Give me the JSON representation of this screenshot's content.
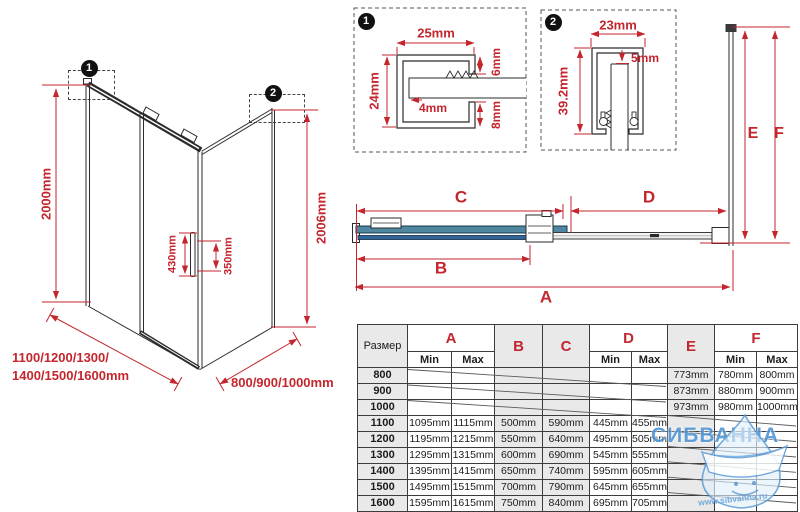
{
  "colors": {
    "dimension_red": "#c4262e",
    "glass_teal": "#4f86a0",
    "glass_blue": "#2f6597",
    "watermark_blue": "#5b9bd5"
  },
  "left_diagram": {
    "badge1": "1",
    "badge2": "2",
    "height_left": "2000mm",
    "height_right": "2006mm",
    "handle_height": "430mm",
    "handle_holes": "350mm",
    "width_options_line1": "1100/1200/1300/",
    "width_options_line2": "1400/1500/1600mm",
    "depth_options": "800/900/1000mm"
  },
  "detail1": {
    "badge": "1",
    "width": "25mm",
    "height": "24mm",
    "top_gap": "6mm",
    "pocket": "4mm",
    "bottom_gap": "8mm"
  },
  "detail2": {
    "badge": "2",
    "width": "23mm",
    "height": "39.2mm",
    "gap": "5mm"
  },
  "dims": {
    "a": "A",
    "b": "B",
    "c": "C",
    "d": "D",
    "e": "E",
    "f": "F"
  },
  "table": {
    "size_header": "Размер",
    "min": "Min",
    "max": "Max",
    "col_a": "A",
    "col_b": "B",
    "col_c": "C",
    "col_d": "D",
    "col_e": "E",
    "col_f": "F",
    "rows": [
      {
        "size": "800",
        "a_min": "",
        "a_max": "",
        "b": "",
        "c": "",
        "d_min": "",
        "d_max": "",
        "e": "773mm",
        "f_min": "780mm",
        "f_max": "800mm"
      },
      {
        "size": "900",
        "a_min": "",
        "a_max": "",
        "b": "",
        "c": "",
        "d_min": "",
        "d_max": "",
        "e": "873mm",
        "f_min": "880mm",
        "f_max": "900mm"
      },
      {
        "size": "1000",
        "a_min": "",
        "a_max": "",
        "b": "",
        "c": "",
        "d_min": "",
        "d_max": "",
        "e": "973mm",
        "f_min": "980mm",
        "f_max": "1000mm"
      },
      {
        "size": "1100",
        "a_min": "1095mm",
        "a_max": "1115mm",
        "b": "500mm",
        "c": "590mm",
        "d_min": "445mm",
        "d_max": "455mm",
        "e": "",
        "f_min": "",
        "f_max": ""
      },
      {
        "size": "1200",
        "a_min": "1195mm",
        "a_max": "1215mm",
        "b": "550mm",
        "c": "640mm",
        "d_min": "495mm",
        "d_max": "505mm",
        "e": "",
        "f_min": "",
        "f_max": ""
      },
      {
        "size": "1300",
        "a_min": "1295mm",
        "a_max": "1315mm",
        "b": "600mm",
        "c": "690mm",
        "d_min": "545mm",
        "d_max": "555mm",
        "e": "",
        "f_min": "",
        "f_max": ""
      },
      {
        "size": "1400",
        "a_min": "1395mm",
        "a_max": "1415mm",
        "b": "650mm",
        "c": "740mm",
        "d_min": "595mm",
        "d_max": "605mm",
        "e": "",
        "f_min": "",
        "f_max": ""
      },
      {
        "size": "1500",
        "a_min": "1495mm",
        "a_max": "1515mm",
        "b": "700mm",
        "c": "790mm",
        "d_min": "645mm",
        "d_max": "655mm",
        "e": "",
        "f_min": "",
        "f_max": ""
      },
      {
        "size": "1600",
        "a_min": "1595mm",
        "a_max": "1615mm",
        "b": "750mm",
        "c": "840mm",
        "d_min": "695mm",
        "d_max": "705mm",
        "e": "",
        "f_min": "",
        "f_max": ""
      }
    ]
  },
  "watermark": {
    "brand": "СИБВАННА",
    "url": "www.sibvanna.ru"
  }
}
